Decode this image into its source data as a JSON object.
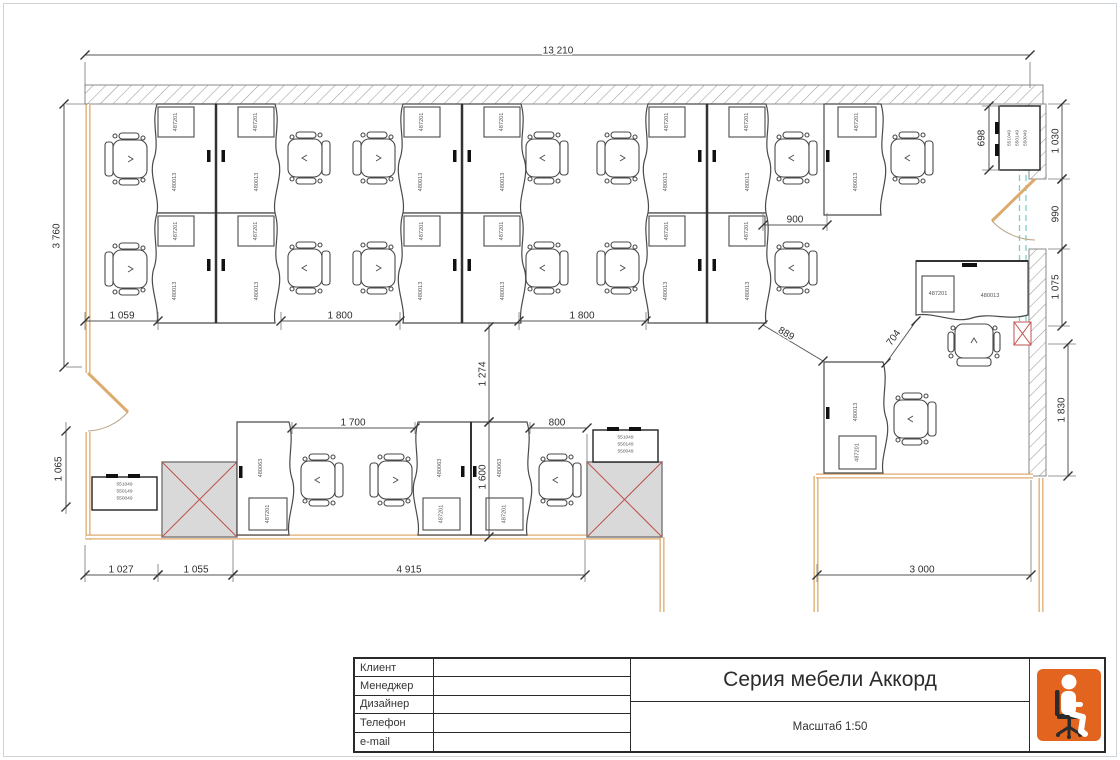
{
  "drawing": {
    "type": "office furniture floor plan",
    "series_title": "Серия мебели Аккорд",
    "scale_note": "Масштаб 1:50"
  },
  "colors": {
    "accent_orange": "#e2641e",
    "wall_tan": "#ddab6e",
    "partition_teal": "#7ccfc9",
    "column_red": "#c0504d",
    "hatch_gray": "#9a9a9a",
    "line_dark": "#4a4a4a"
  },
  "title_block": {
    "rows": [
      {
        "label": "Клиент",
        "value": ""
      },
      {
        "label": "Менеджер",
        "value": ""
      },
      {
        "label": "Дизайнер",
        "value": ""
      },
      {
        "label": "Телефон",
        "value": ""
      },
      {
        "label": "e-mail",
        "value": ""
      }
    ],
    "title": "Серия мебели Аккорд",
    "scale": "Масштаб 1:50",
    "logo_icon": "person-on-office-chair-icon"
  },
  "furniture": {
    "workstation_desk_code": "480013",
    "meeting_desk_code": "480063",
    "pedestal_code": "487201",
    "cabinet_codes": [
      "551049",
      "550149",
      "550049"
    ]
  },
  "dimensions": [
    {
      "t": "13 210",
      "x1": 85,
      "y1": 55,
      "x2": 1030,
      "y2": 55,
      "lx": 558,
      "ly": 51,
      "rot": 0
    },
    {
      "t": "3 760",
      "x1": 64,
      "y1": 104,
      "x2": 64,
      "y2": 367,
      "lx": 57,
      "ly": 236,
      "rot": -90
    },
    {
      "t": "1 059",
      "x1": 85,
      "y1": 321,
      "x2": 158,
      "y2": 321,
      "lx": 122,
      "ly": 316,
      "rot": 0
    },
    {
      "t": "1 800",
      "x1": 281,
      "y1": 321,
      "x2": 400,
      "y2": 321,
      "lx": 340,
      "ly": 316,
      "rot": 0
    },
    {
      "t": "1 800",
      "x1": 519,
      "y1": 321,
      "x2": 646,
      "y2": 321,
      "lx": 582,
      "ly": 316,
      "rot": 0
    },
    {
      "t": "900",
      "x1": 763,
      "y1": 225,
      "x2": 827,
      "y2": 225,
      "lx": 795,
      "ly": 220,
      "rot": 0
    },
    {
      "t": "698",
      "x1": 989,
      "y1": 106,
      "x2": 989,
      "y2": 170,
      "lx": 982,
      "ly": 138,
      "rot": -90
    },
    {
      "t": "1 030",
      "x1": 1062,
      "y1": 104,
      "x2": 1062,
      "y2": 179,
      "lx": 1056,
      "ly": 141,
      "rot": -90
    },
    {
      "t": "990",
      "x1": 1062,
      "y1": 179,
      "x2": 1062,
      "y2": 249,
      "lx": 1056,
      "ly": 214,
      "rot": -90
    },
    {
      "t": "1 075",
      "x1": 1062,
      "y1": 249,
      "x2": 1062,
      "y2": 326,
      "lx": 1056,
      "ly": 287,
      "rot": -90
    },
    {
      "t": "1 830",
      "x1": 1068,
      "y1": 344,
      "x2": 1068,
      "y2": 476,
      "lx": 1062,
      "ly": 410,
      "rot": -90
    },
    {
      "t": "1 274",
      "x1": 489,
      "y1": 327,
      "x2": 489,
      "y2": 422,
      "lx": 483,
      "ly": 374,
      "rot": -90
    },
    {
      "t": "1 600",
      "x1": 489,
      "y1": 422,
      "x2": 489,
      "y2": 537,
      "lx": 483,
      "ly": 477,
      "rot": -90
    },
    {
      "t": "1 700",
      "x1": 292,
      "y1": 428,
      "x2": 415,
      "y2": 428,
      "lx": 353,
      "ly": 423,
      "rot": 0
    },
    {
      "t": "800",
      "x1": 530,
      "y1": 428,
      "x2": 587,
      "y2": 428,
      "lx": 557,
      "ly": 423,
      "rot": 0
    },
    {
      "t": "889",
      "x1": 763,
      "y1": 325,
      "x2": 823,
      "y2": 361,
      "lx": 786,
      "ly": 334,
      "rot": 31
    },
    {
      "t": "704",
      "x1": 886,
      "y1": 363,
      "x2": 916,
      "y2": 321,
      "lx": 894,
      "ly": 338,
      "rot": -54
    },
    {
      "t": "1 065",
      "x1": 66,
      "y1": 431,
      "x2": 66,
      "y2": 507,
      "lx": 59,
      "ly": 469,
      "rot": -90
    },
    {
      "t": "1 027",
      "x1": 85,
      "y1": 575,
      "x2": 158,
      "y2": 575,
      "lx": 121,
      "ly": 570,
      "rot": 0
    },
    {
      "t": "1 055",
      "x1": 158,
      "y1": 575,
      "x2": 233,
      "y2": 575,
      "lx": 196,
      "ly": 570,
      "rot": 0
    },
    {
      "t": "4 915",
      "x1": 233,
      "y1": 575,
      "x2": 585,
      "y2": 575,
      "lx": 409,
      "ly": 570,
      "rot": 0
    },
    {
      "t": "3 000",
      "x1": 817,
      "y1": 575,
      "x2": 1031,
      "y2": 575,
      "lx": 922,
      "ly": 570,
      "rot": 0
    }
  ]
}
